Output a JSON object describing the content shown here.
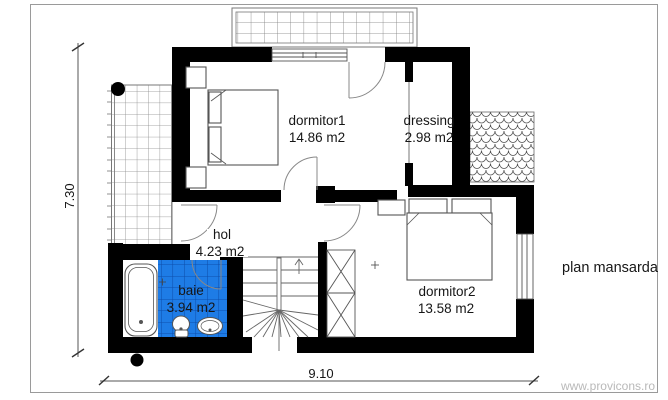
{
  "page": {
    "title": "plan mansarda",
    "watermark": "www.provicons.ro"
  },
  "dimensions": {
    "total_width_m": "9.10",
    "total_height_m": "7.30"
  },
  "rooms": {
    "dormitor1": {
      "label": "dormitor1",
      "area": "14.86 m2"
    },
    "dressing": {
      "label": "dressing",
      "area": "2.98 m2"
    },
    "hol": {
      "label": "hol",
      "area": "4.23 m2"
    },
    "baie": {
      "label": "baie",
      "area": "3.94 m2"
    },
    "dormitor2": {
      "label": "dormitor2",
      "area": "13.58 m2"
    }
  },
  "colors": {
    "wall": "#000000",
    "tile": "#1e7ce6",
    "tile_line": "#0d4fae",
    "line": "#666666",
    "watermark": "#b9b9b9"
  }
}
